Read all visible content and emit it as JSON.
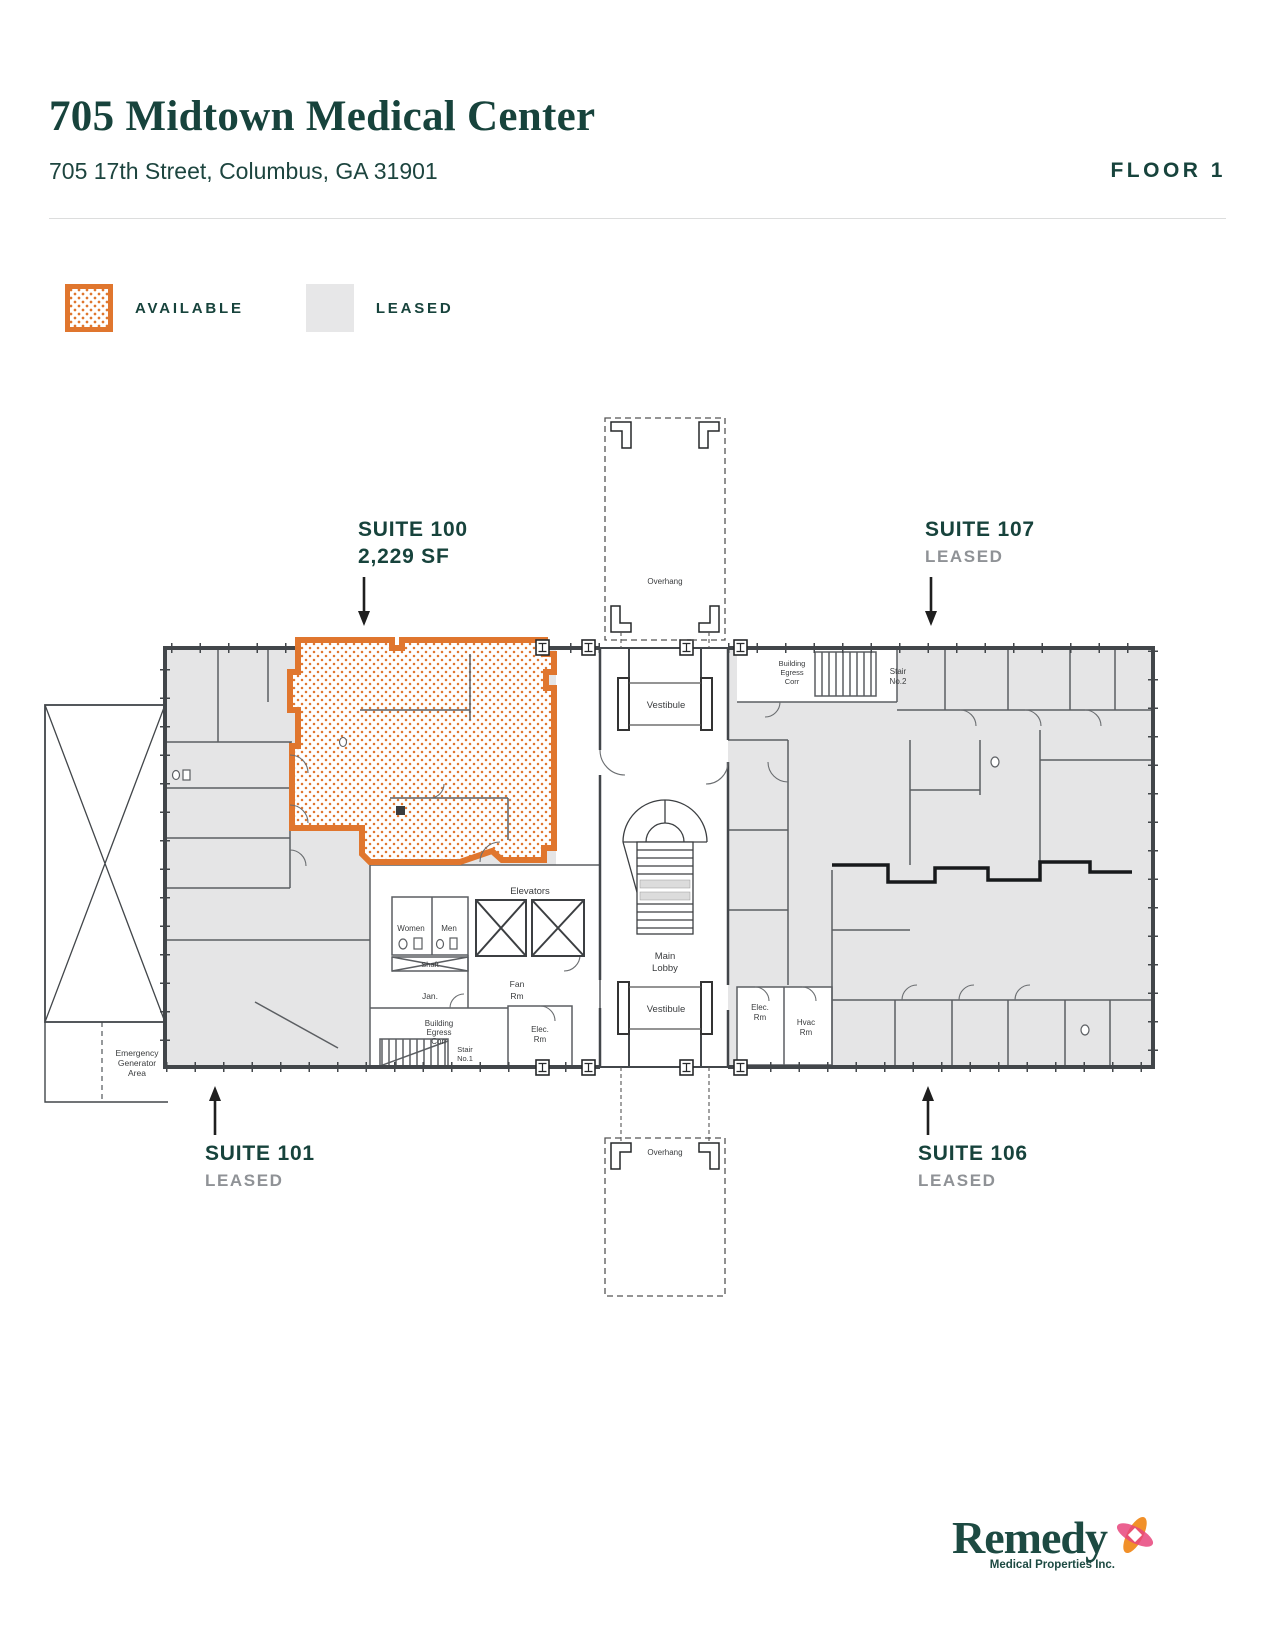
{
  "header": {
    "title": "705 Midtown Medical Center",
    "address": "705 17th Street, Columbus, GA 31901",
    "floor_label": "FLOOR 1"
  },
  "legend": {
    "available_label": "AVAILABLE",
    "leased_label": "LEASED"
  },
  "colors": {
    "brand_teal": "#17433c",
    "available_orange": "#e0762e",
    "leased_fill": "#e5e5e6",
    "status_gray": "#8f9296",
    "wall_gray": "#42464a"
  },
  "suites": {
    "s100": {
      "name": "SUITE 100",
      "detail": "2,229 SF",
      "status": "available"
    },
    "s107": {
      "name": "SUITE 107",
      "detail": "LEASED",
      "status": "leased"
    },
    "s101": {
      "name": "SUITE 101",
      "detail": "LEASED",
      "status": "leased"
    },
    "s106": {
      "name": "SUITE 106",
      "detail": "LEASED",
      "status": "leased"
    }
  },
  "plan": {
    "overhang": "Overhang",
    "vestibule": "Vestibule",
    "main_lobby": [
      "Main",
      "Lobby"
    ],
    "elevators": "Elevators",
    "women": "Women",
    "men": "Men",
    "shaft": "Shaft",
    "jan": "Jan.",
    "fan_rm": [
      "Fan",
      "Rm"
    ],
    "elec_rm": [
      "Elec.",
      "Rm"
    ],
    "hvac_rm": [
      "Hvac",
      "Rm"
    ],
    "building_egress": [
      "Building",
      "Egress",
      "Corr"
    ],
    "stair_no1": [
      "Stair",
      "No.1"
    ],
    "stair_no2": [
      "Stair",
      "No.2"
    ],
    "emergency_generator": [
      "Emergency",
      "Generator",
      "Area"
    ]
  },
  "footer": {
    "brand": "Remedy",
    "sub": "Medical Properties Inc."
  }
}
